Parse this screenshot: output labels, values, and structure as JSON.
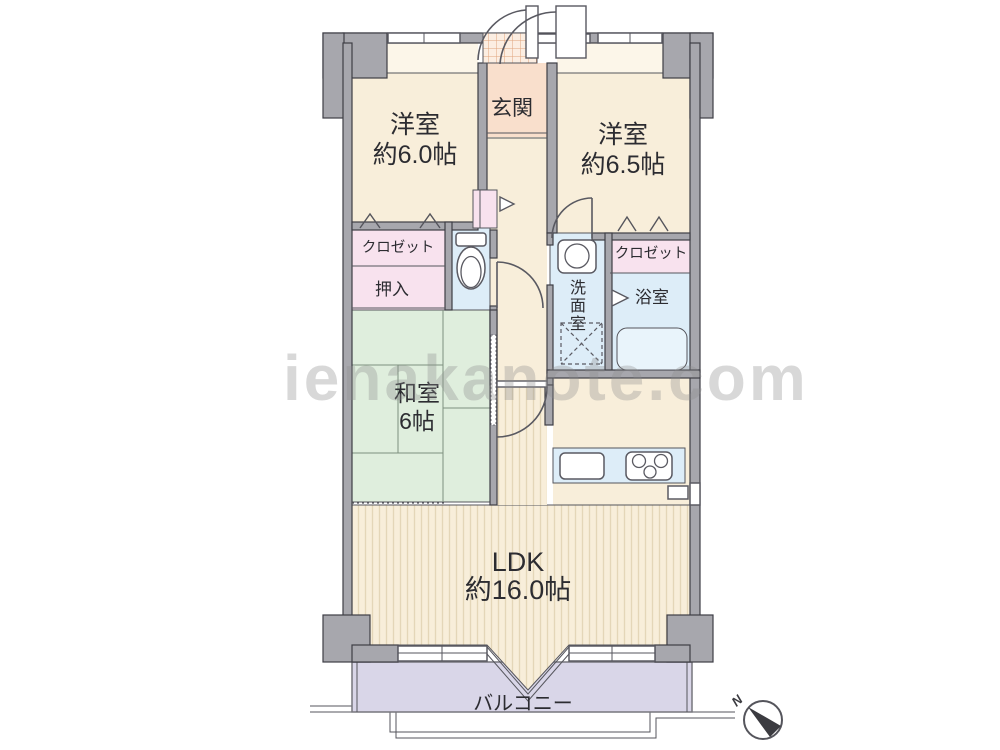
{
  "watermark": {
    "text": "ienakanote.com"
  },
  "compass": {
    "label": "N"
  },
  "rooms": {
    "bedroom1": {
      "name": "洋室",
      "size": "約6.0帖"
    },
    "bedroom2": {
      "name": "洋室",
      "size": "約6.5帖"
    },
    "entrance": {
      "label": "玄関"
    },
    "closet_left": {
      "label": "クロゼット"
    },
    "oshiire": {
      "label": "押入"
    },
    "washroom": {
      "label": "洗面室",
      "chars": [
        "洗",
        "面",
        "室"
      ]
    },
    "closet_right": {
      "label": "クロゼット"
    },
    "bathroom": {
      "label": "浴室"
    },
    "japanese_room": {
      "name": "和室",
      "size": "6帖"
    },
    "ldk": {
      "name": "LDK",
      "size": "約16.0帖"
    },
    "balcony": {
      "label": "バルコニー"
    }
  },
  "colors": {
    "wall": "#a7a7ad",
    "cream": "#f8eeda",
    "band": "#fcf6e9",
    "entrance": "#f9dfcc",
    "porch": "#fceee2",
    "pink": "#f8e2ee",
    "blue": "#ddedf8",
    "tub": "#e9f4fb",
    "green": "#dfeedd",
    "balcony": "#d9d6e8"
  }
}
